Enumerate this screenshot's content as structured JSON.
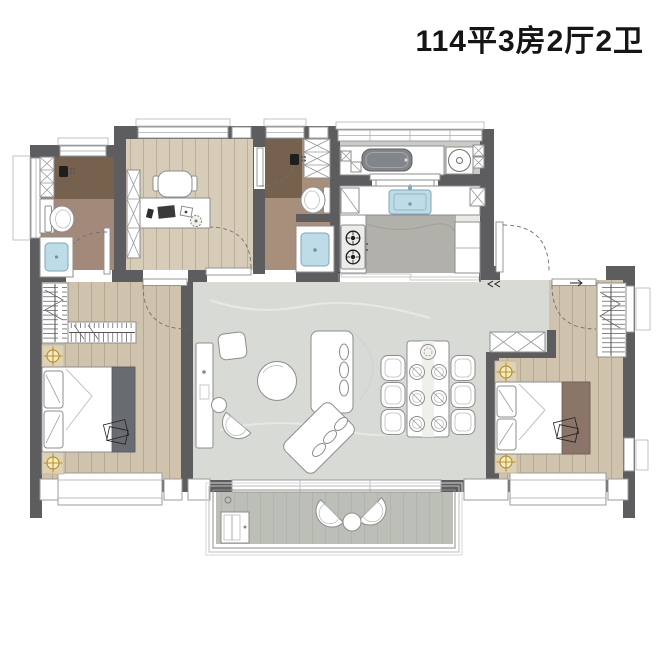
{
  "title": "114平3房2厅2卫",
  "title_parsed": {
    "area_sqm": "114",
    "bedrooms": "3",
    "halls": "2",
    "bathrooms": "2"
  },
  "palette": {
    "wall": "#5d5d60",
    "wood_floor": "#cfc3ad",
    "study_floor": "#d7ccb7",
    "marble_floor": "#d8dad5",
    "bath_floor": "#a2897a",
    "shower_floor": "#76604e",
    "kitchen_floor_center": "#b1b0aa",
    "utility_floor": "#c9cbc5",
    "balcony_floor": "#bcbeb8",
    "sink_blue": "#bedbe8",
    "accent_gold": "#b8922d",
    "furniture_outline": "#8d8d8d",
    "title_text": "#151515"
  },
  "symbols": [
    "shower-icon",
    "toilet-icon",
    "sink-icon",
    "stove-burner-icon",
    "washing-machine-icon",
    "wardrobe-hanger-icon",
    "light-crosshair-icon",
    "door-swing-arc",
    "window-glazing"
  ]
}
